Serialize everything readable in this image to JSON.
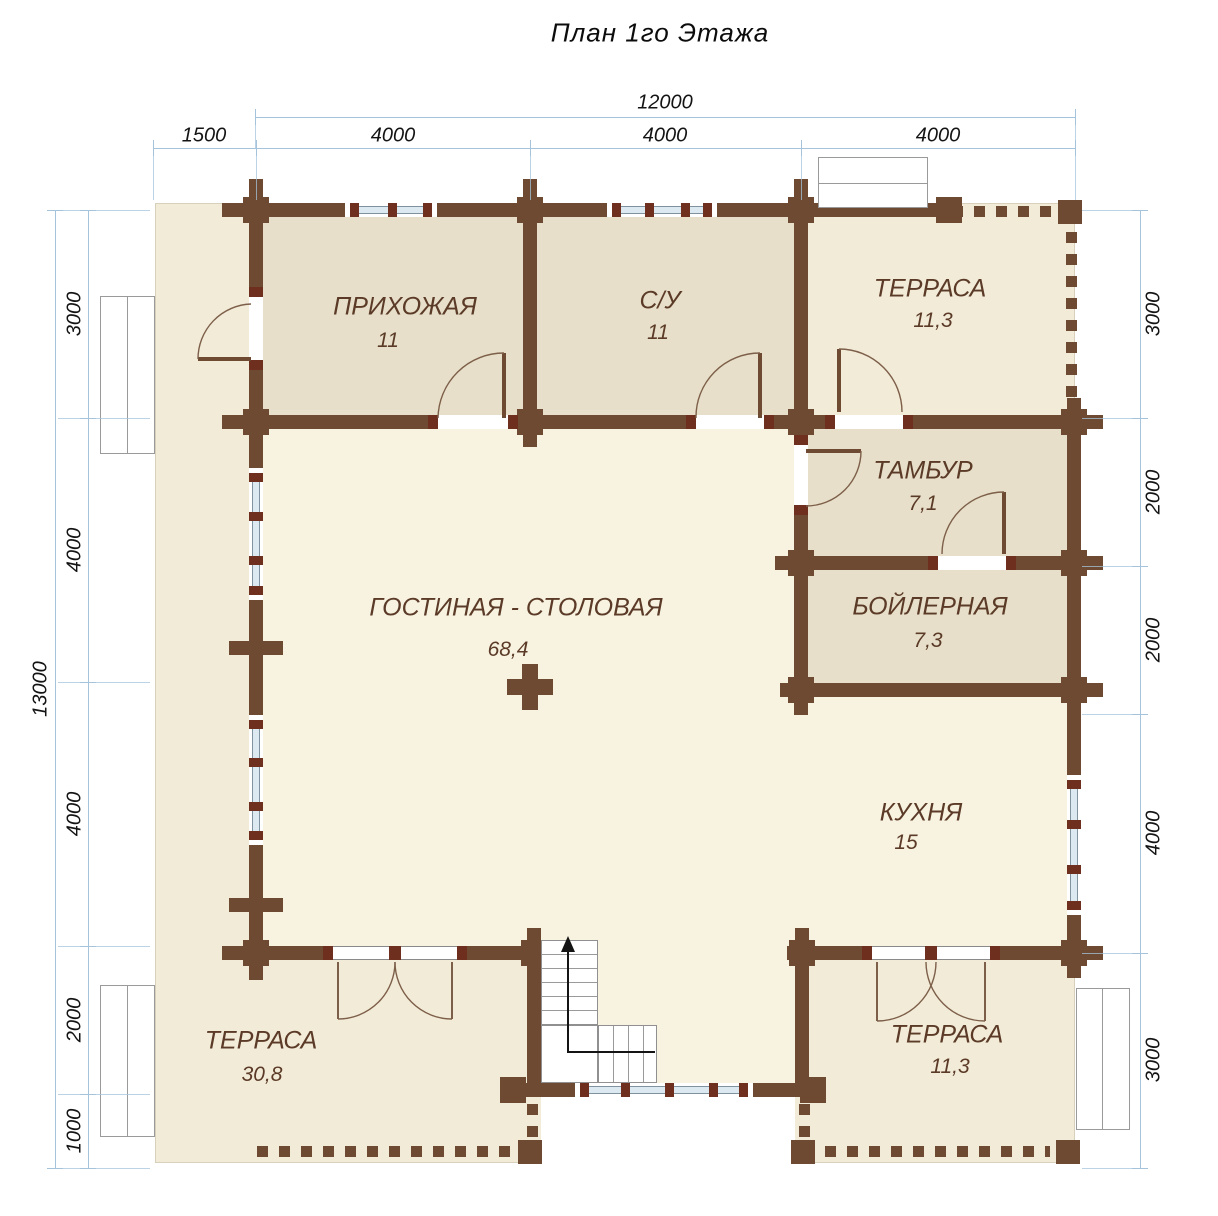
{
  "title": "План 1го Этажа",
  "dims": {
    "top_total": "12000",
    "top_segments": [
      "1500",
      "4000",
      "4000",
      "4000"
    ],
    "left_total": "13000",
    "left_segments": [
      "3000",
      "4000",
      "4000",
      "2000",
      "1000"
    ],
    "right_segments": [
      "3000",
      "2000",
      "2000",
      "4000",
      "3000"
    ]
  },
  "rooms": [
    {
      "name": "ПРИХОЖАЯ",
      "area": "11"
    },
    {
      "name": "С/У",
      "area": "11"
    },
    {
      "name": "ТЕРРАСА",
      "area": "11,3"
    },
    {
      "name": "ТАМБУР",
      "area": "7,1"
    },
    {
      "name": "БОЙЛЕРНАЯ",
      "area": "7,3"
    },
    {
      "name": "ГОСТИНАЯ - СТОЛОВАЯ",
      "area": "68,4"
    },
    {
      "name": "КУХНЯ",
      "area": "15"
    },
    {
      "name": "ТЕРРАСА",
      "area": "30,8"
    },
    {
      "name": "ТЕРРАСА",
      "area": "11,3"
    }
  ],
  "colors": {
    "wall": "#6E4A33",
    "accent": "#6F2F1F",
    "room_fill": "#E7DFC9",
    "floor_fill": "#F8F2E1",
    "terrace_fill": "#F2EBD8",
    "window_glass": "#DCE9F0",
    "dim_line": "#A5C4DC",
    "label_text": "#5B3B27"
  }
}
